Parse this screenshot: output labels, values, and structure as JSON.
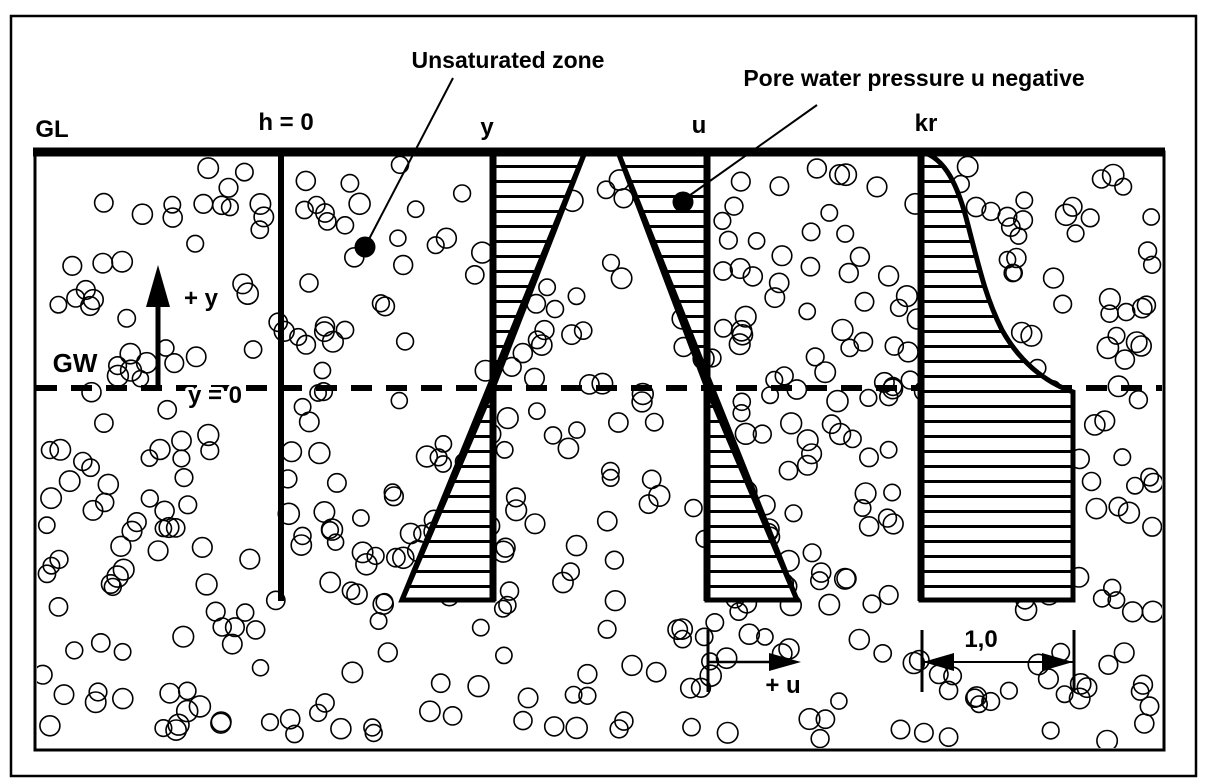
{
  "diagram": {
    "annotations": {
      "unsaturated_zone": "Unsaturated zone",
      "pore_water_pressure": "Pore water pressure u negative"
    },
    "axis_labels": {
      "ground_level": "GL",
      "head_zero": "h = 0",
      "y_axis": "y",
      "u_axis": "u",
      "kr_axis": "kr"
    },
    "water_table": {
      "groundwater": "GW",
      "y_zero": "y = 0"
    },
    "arrows": {
      "plus_y": "+ y",
      "plus_u": "+ u",
      "kr_dimension": "1,0"
    },
    "colors": {
      "ink": "#000000",
      "background": "#ffffff"
    }
  }
}
